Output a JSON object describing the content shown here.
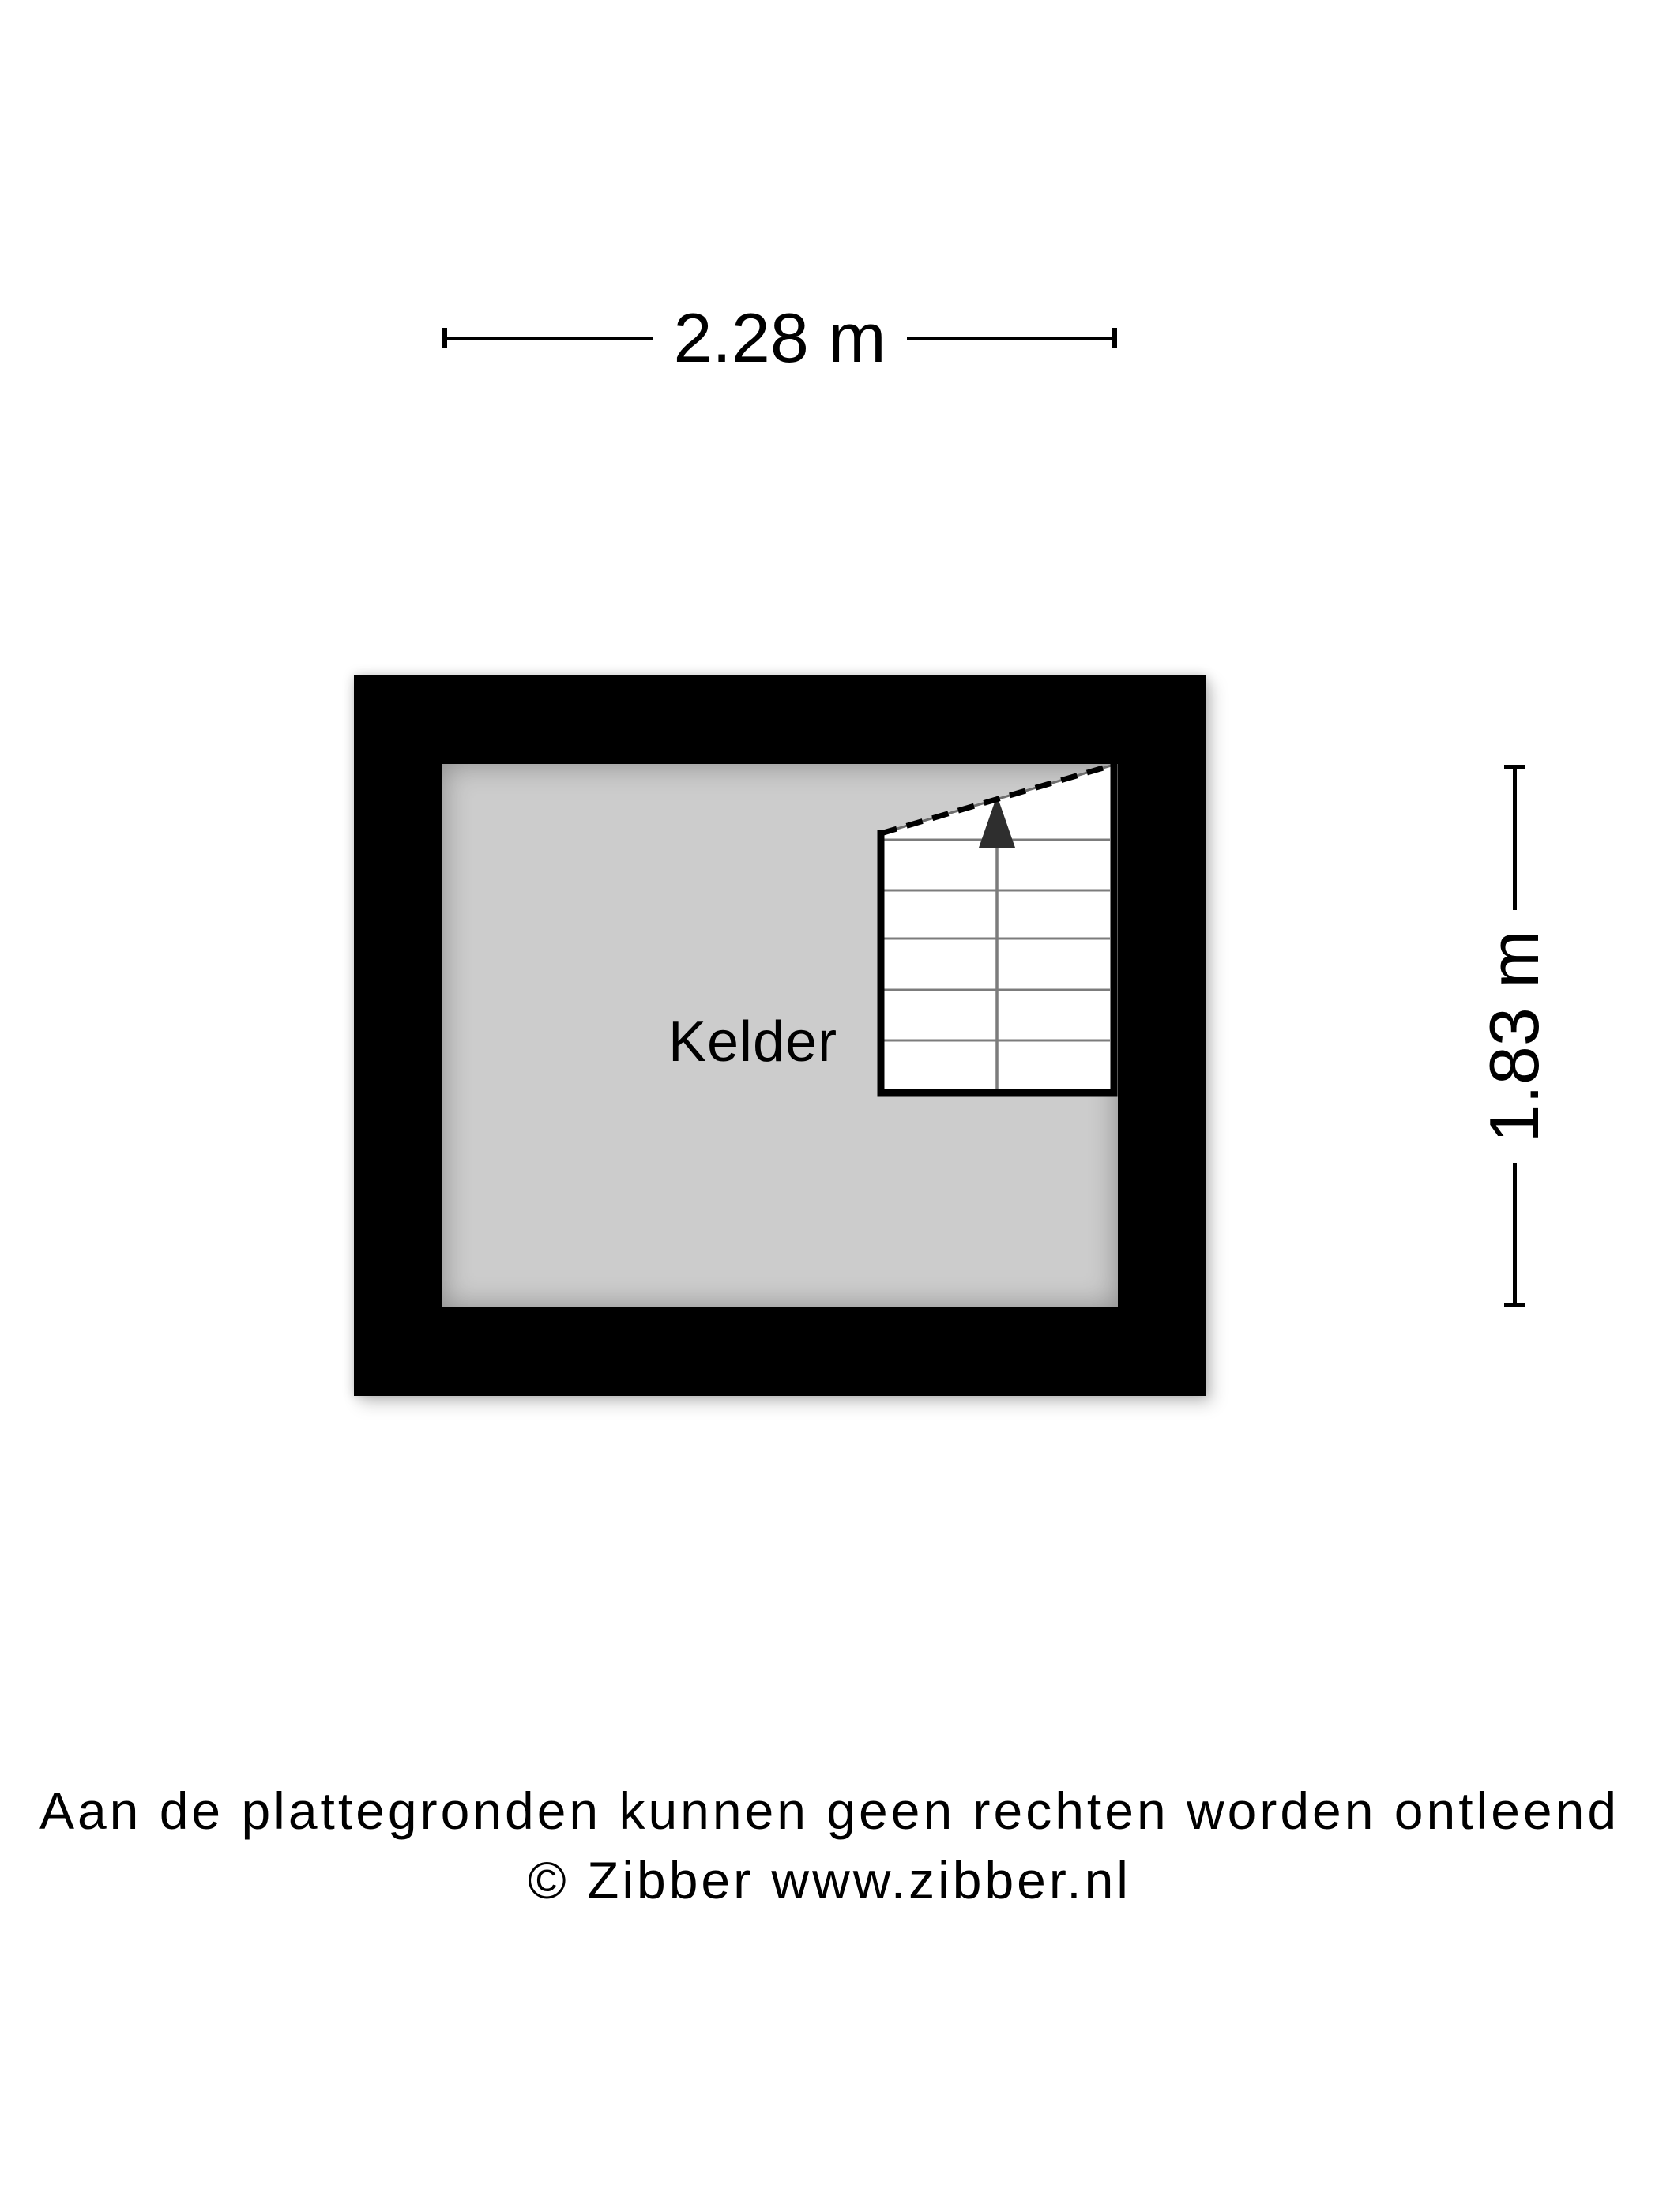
{
  "dimensions": {
    "width": {
      "label": "2.28 m"
    },
    "height": {
      "label": "1.83 m"
    }
  },
  "floorplan": {
    "room": {
      "label": "Kelder"
    },
    "stairs": {
      "arrow_direction": "up"
    },
    "colors": {
      "background": "#ffffff",
      "wall": "#000000",
      "floor": "#cccccc",
      "stair_fill": "#ffffff",
      "stair_border": "#000000",
      "stair_cut_line": "#6e6e6e",
      "tread_line": "#7c7c7c",
      "arrow": "#2e2e2e",
      "dimension_line": "#000000",
      "text": "#000000"
    }
  },
  "footer": {
    "disclaimer": "Aan de plattegronden kunnen geen rechten worden ontleend",
    "copyright": "© Zibber www.zibber.nl"
  }
}
